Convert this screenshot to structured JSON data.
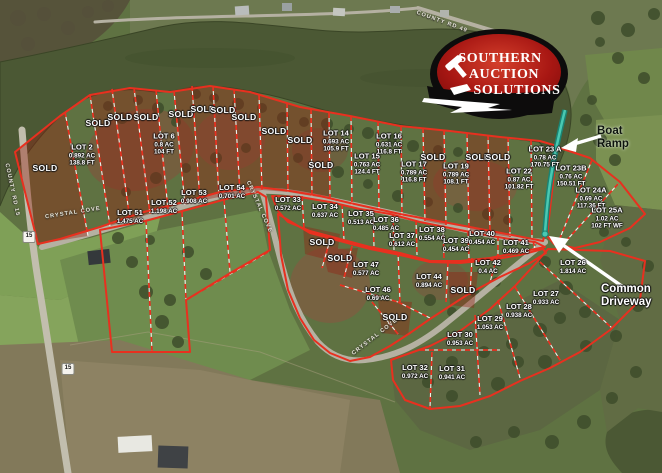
{
  "logo": {
    "line1": "SOUTHERN",
    "line2": "AUCTION",
    "line3": "SOLUTIONS"
  },
  "annotations": {
    "boat_ramp": {
      "line1": "Boat",
      "line2": "Ramp"
    },
    "common_driveway": {
      "line1": "Common",
      "line2": "Driveway"
    }
  },
  "labels": {
    "sold": "SOLD"
  },
  "lots": [
    {
      "name": "LOT 2",
      "acres": "0.892 AC",
      "front": "138.8 FT",
      "x": 82,
      "y": 155
    },
    {
      "name": "LOT 6",
      "acres": "0.8 AC",
      "front": "104 FT",
      "x": 164,
      "y": 144
    },
    {
      "name": "LOT 14",
      "acres": "0.693 AC",
      "front": "105.9 FT",
      "x": 336,
      "y": 141
    },
    {
      "name": "LOT 15",
      "acres": "0.763 AC",
      "front": "124.4 FT",
      "x": 367,
      "y": 164
    },
    {
      "name": "LOT 16",
      "acres": "0.631 AC",
      "front": "116.8 FT",
      "x": 389,
      "y": 144
    },
    {
      "name": "LOT 17",
      "acres": "0.789 AC",
      "front": "116.8 FT",
      "x": 414,
      "y": 172
    },
    {
      "name": "LOT 19",
      "acres": "0.789 AC",
      "front": "108.1 FT",
      "x": 456,
      "y": 174
    },
    {
      "name": "LOT 22",
      "acres": "0.87 AC",
      "front": "101.82 FT",
      "x": 519,
      "y": 179
    },
    {
      "name": "LOT 23 A",
      "acres": "0.78 AC",
      "front": "170.75 FT",
      "x": 545,
      "y": 157
    },
    {
      "name": "LOT 23B",
      "acres": "0.76 AC",
      "front": "150.51 FT",
      "x": 571,
      "y": 176
    },
    {
      "name": "LOT 24A",
      "acres": "0.69 AC",
      "front": "117.36 FT",
      "x": 591,
      "y": 198
    },
    {
      "name": "LOT 25A",
      "acres": "1.02 AC",
      "front": "102 FT WF",
      "x": 607,
      "y": 218
    },
    {
      "name": "LOT 26",
      "acres": "1.814 AC",
      "front": "",
      "x": 573,
      "y": 267
    },
    {
      "name": "LOT 27",
      "acres": "0.933 AC",
      "front": "",
      "x": 546,
      "y": 298
    },
    {
      "name": "LOT 28",
      "acres": "0.938 AC",
      "front": "",
      "x": 519,
      "y": 311
    },
    {
      "name": "LOT 29",
      "acres": "1.053 AC",
      "front": "",
      "x": 490,
      "y": 323
    },
    {
      "name": "LOT 30",
      "acres": "0.953 AC",
      "front": "",
      "x": 460,
      "y": 339
    },
    {
      "name": "LOT 31",
      "acres": "0.941 AC",
      "front": "",
      "x": 452,
      "y": 373
    },
    {
      "name": "LOT 32",
      "acres": "0.972 AC",
      "front": "",
      "x": 415,
      "y": 372
    },
    {
      "name": "LOT 33",
      "acres": "0.572 AC",
      "front": "",
      "x": 288,
      "y": 204
    },
    {
      "name": "LOT 34",
      "acres": "0.637 AC",
      "front": "",
      "x": 325,
      "y": 211
    },
    {
      "name": "LOT 35",
      "acres": "0.513 AC",
      "front": "",
      "x": 361,
      "y": 218
    },
    {
      "name": "LOT 36",
      "acres": "0.485 AC",
      "front": "",
      "x": 386,
      "y": 224
    },
    {
      "name": "LOT 37",
      "acres": "0.612 AC",
      "front": "",
      "x": 402,
      "y": 240
    },
    {
      "name": "LOT 38",
      "acres": "0.554 AC",
      "front": "",
      "x": 432,
      "y": 234
    },
    {
      "name": "LOT 39",
      "acres": "0.454 AC",
      "front": "",
      "x": 456,
      "y": 245
    },
    {
      "name": "LOT 40",
      "acres": "0.454 AC",
      "front": "",
      "x": 482,
      "y": 238
    },
    {
      "name": "LOT 41",
      "acres": "0.469 AC",
      "front": "",
      "x": 516,
      "y": 247
    },
    {
      "name": "LOT 42",
      "acres": "0.4 AC",
      "front": "",
      "x": 488,
      "y": 267
    },
    {
      "name": "LOT 44",
      "acres": "0.894 AC",
      "front": "",
      "x": 429,
      "y": 281
    },
    {
      "name": "LOT 46",
      "acres": "0.69 AC",
      "front": "",
      "x": 378,
      "y": 294
    },
    {
      "name": "LOT 47",
      "acres": "0.577 AC",
      "front": "",
      "x": 366,
      "y": 269
    },
    {
      "name": "LOT 51",
      "acres": "1.475 AC",
      "front": "",
      "x": 130,
      "y": 217
    },
    {
      "name": "LOT 52",
      "acres": "1.198 AC",
      "front": "",
      "x": 164,
      "y": 207
    },
    {
      "name": "LOT 53",
      "acres": "0.908 AC",
      "front": "",
      "x": 194,
      "y": 197
    },
    {
      "name": "LOT 54",
      "acres": "0.701 AC",
      "front": "",
      "x": 232,
      "y": 192
    }
  ],
  "sold_markers": [
    {
      "x": 45,
      "y": 168
    },
    {
      "x": 98,
      "y": 123
    },
    {
      "x": 120,
      "y": 117
    },
    {
      "x": 146,
      "y": 117
    },
    {
      "x": 181,
      "y": 114
    },
    {
      "x": 203,
      "y": 109
    },
    {
      "x": 223,
      "y": 110
    },
    {
      "x": 244,
      "y": 117
    },
    {
      "x": 274,
      "y": 131
    },
    {
      "x": 300,
      "y": 140
    },
    {
      "x": 321,
      "y": 165
    },
    {
      "x": 433,
      "y": 157
    },
    {
      "x": 478,
      "y": 157
    },
    {
      "x": 498,
      "y": 157
    },
    {
      "x": 322,
      "y": 242
    },
    {
      "x": 340,
      "y": 258
    },
    {
      "x": 463,
      "y": 290
    },
    {
      "x": 395,
      "y": 317
    }
  ],
  "road_labels": [
    {
      "text": "COUNTY RD 15",
      "x": 12,
      "y": 190,
      "rot": 78
    },
    {
      "text": "COUNTY RD 49",
      "x": 442,
      "y": 22,
      "rot": 20
    },
    {
      "text": "CRYSTAL COVE",
      "x": 73,
      "y": 213,
      "rot": -9
    },
    {
      "text": "CRYSTAL COVE",
      "x": 259,
      "y": 207,
      "rot": 66
    },
    {
      "text": "CRYSTAL COVE",
      "x": 375,
      "y": 337,
      "rot": -38
    }
  ],
  "shields": [
    {
      "n": "15",
      "x": 29,
      "y": 237
    },
    {
      "n": "15",
      "x": 68,
      "y": 369
    }
  ],
  "colors": {
    "lot_line_red": "#e8301f",
    "sold_fill": "#8f2012",
    "boat_ramp_teal": "#2fa893",
    "water": "#4b5834",
    "logo_red": "#b01812"
  }
}
